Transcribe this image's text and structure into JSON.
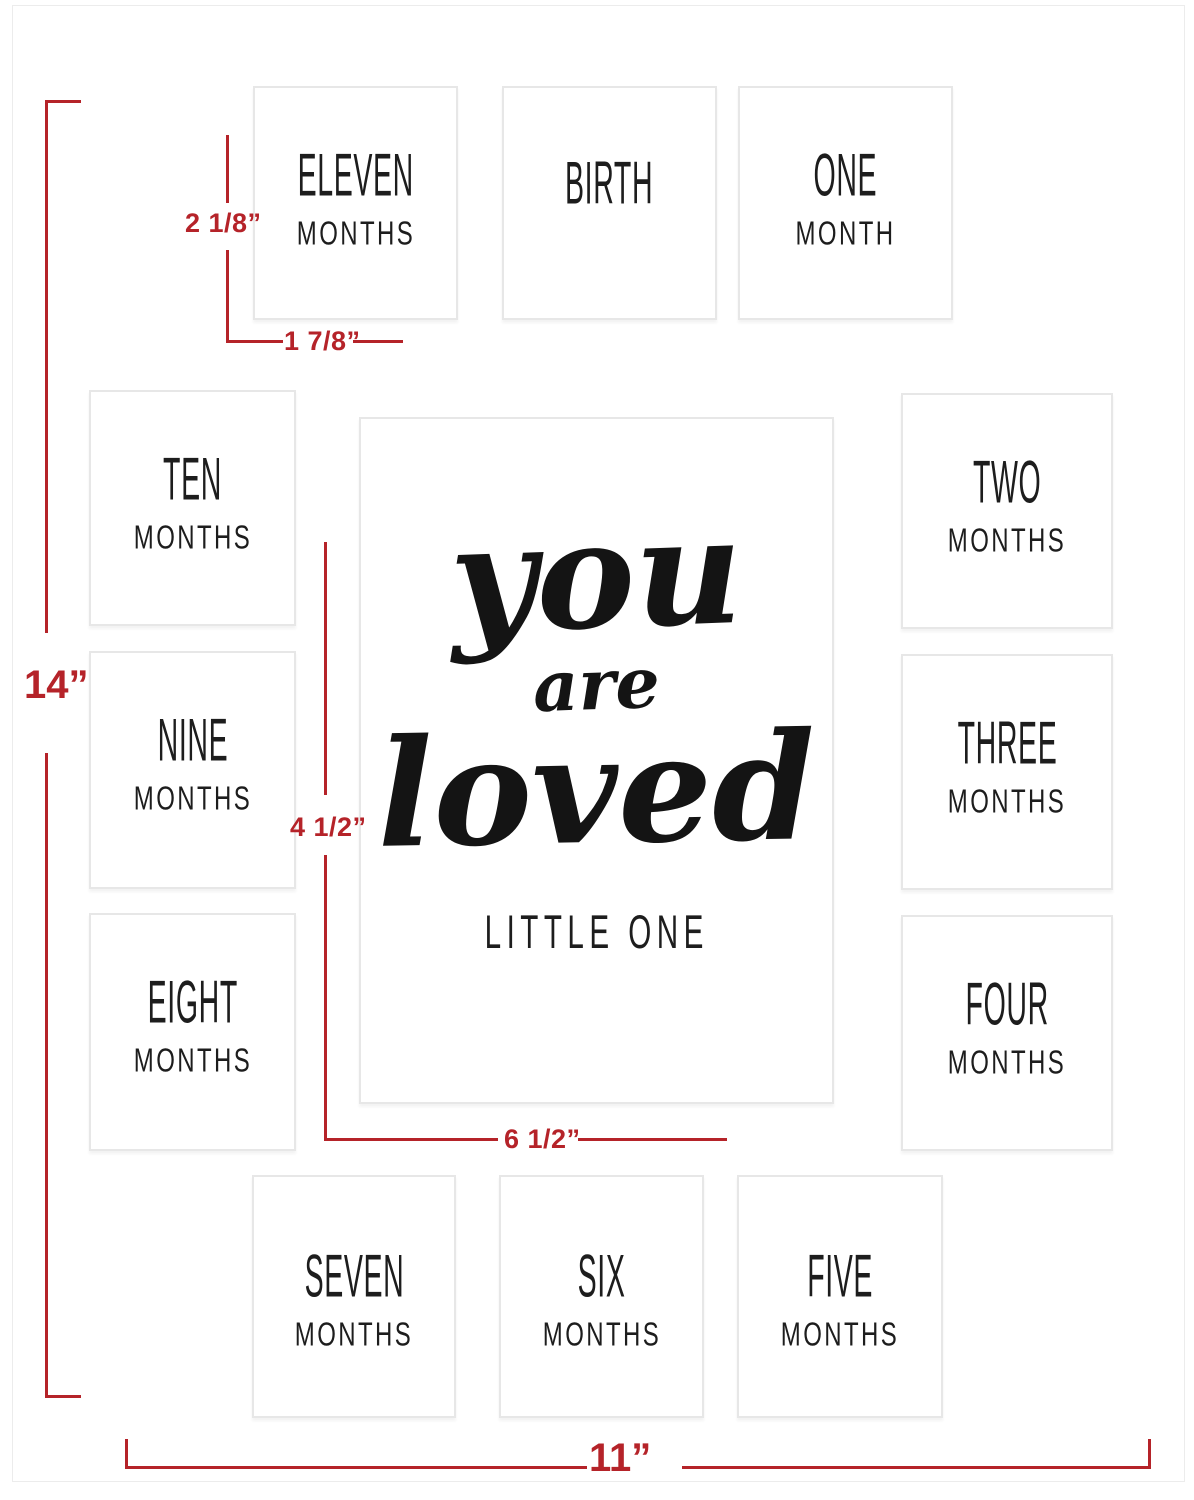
{
  "product": "baby-milestone-picture-frame-mat",
  "center": {
    "script": [
      "you",
      "are",
      "loved"
    ],
    "subtitle": "LITTLE ONE"
  },
  "openings": [
    {
      "word": "ELEVEN",
      "sub": "MONTHS"
    },
    {
      "word": "BIRTH",
      "sub": ""
    },
    {
      "word": "ONE",
      "sub": "MONTH"
    },
    {
      "word": "TEN",
      "sub": "MONTHS"
    },
    {
      "word": "TWO",
      "sub": "MONTHS"
    },
    {
      "word": "NINE",
      "sub": "MONTHS"
    },
    {
      "word": "THREE",
      "sub": "MONTHS"
    },
    {
      "word": "EIGHT",
      "sub": "MONTHS"
    },
    {
      "word": "FOUR",
      "sub": "MONTHS"
    },
    {
      "word": "SEVEN",
      "sub": "MONTHS"
    },
    {
      "word": "SIX",
      "sub": "MONTHS"
    },
    {
      "word": "FIVE",
      "sub": "MONTHS"
    }
  ],
  "dimensions": {
    "overall_height": "14”",
    "overall_width": "11”",
    "small_opening_height": "2 1/8”",
    "small_opening_width": "1 7/8”",
    "center_opening_vertical": "4 1/2”",
    "center_opening_horizontal": "6 1/2”"
  },
  "colors": {
    "dimension_red": "#b52329",
    "label_black": "#1d1d1d",
    "border_gray": "#e7e7e7"
  }
}
